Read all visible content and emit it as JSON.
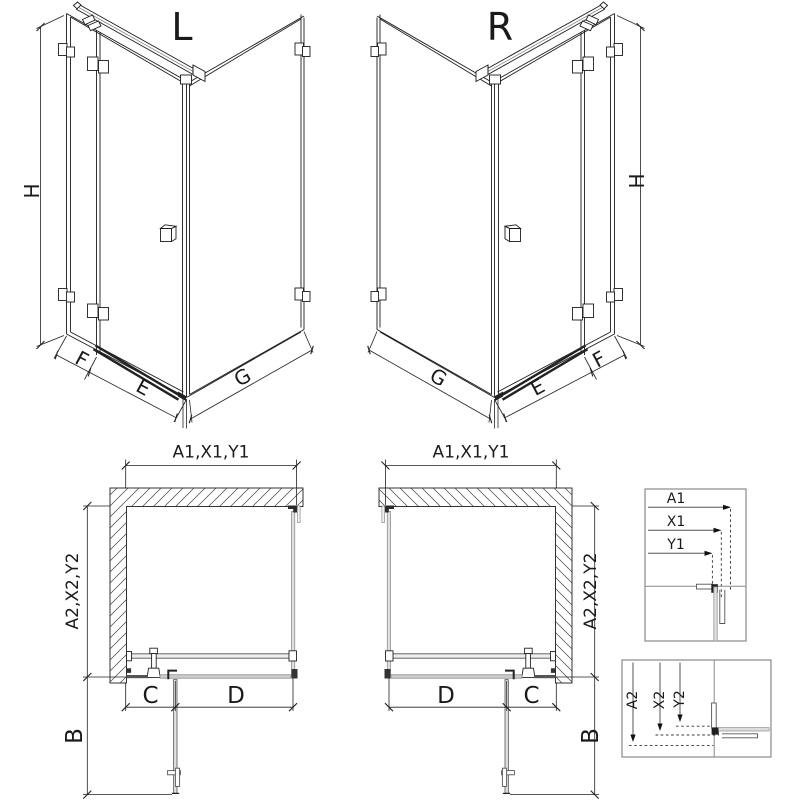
{
  "views": {
    "perspective_left": {
      "title": "L"
    },
    "perspective_right": {
      "title": "R"
    },
    "labels": {
      "height": "H",
      "fixed_panel_width": "F",
      "door_width": "E",
      "side_panel_width": "G"
    }
  },
  "plan": {
    "front_width": "A1,X1,Y1",
    "side_depth": "A2,X2,Y2",
    "wall_to_hinge": "C",
    "door_opening": "D",
    "open_door_projection": "B"
  },
  "details": {
    "width_box": {
      "a1": "A1",
      "x1": "X1",
      "y1": "Y1"
    },
    "depth_box": {
      "a2": "A2",
      "x2": "X2",
      "y2": "Y2"
    }
  },
  "colors": {
    "line": "#1c1c1c",
    "dimension": "#222222",
    "glass_gray": "#999999",
    "fill_light": "#e0e0e0",
    "detail_border": "#8a8a8a",
    "background": "#ffffff"
  }
}
